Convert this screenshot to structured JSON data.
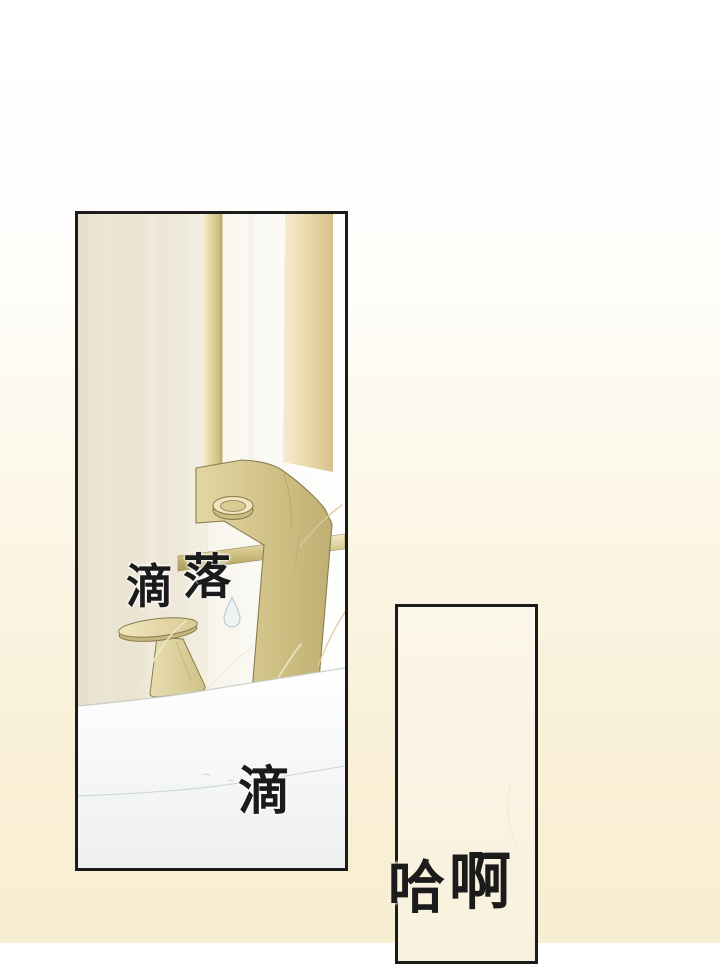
{
  "page": {
    "kind": "webtoon comic page",
    "scene": "bathroom brass faucet dripping into white sink; second partially-visible empty panel"
  },
  "sfx": {
    "drip_fall": "滴落",
    "drip_fall_char1": "滴",
    "drip_fall_char2": "落",
    "drip": "滴",
    "sigh": "哈啊",
    "sigh_char1": "哈",
    "sigh_char2": "啊"
  },
  "colors": {
    "ink": "#1b1b1b",
    "page_top": "#ffffff",
    "page_bottom": "#f8eed2",
    "panel2_top": "#fbf6ea",
    "panel2_fill": "#f8f1dd",
    "halo_white": "#ffffff",
    "halo_cream": "#f8f1dd",
    "brass_outline": "#8a7c4e",
    "brass_hi": "#f4edcd",
    "brass_light": "#e6d8a0",
    "brass_mid": "#d2c284",
    "brass_dark": "#bfae6e",
    "rail_hi": "#f4ebc6",
    "rail_dark": "#a99855",
    "faucet_light": "#e2d6a4",
    "faucet_mid": "#cfc084",
    "faucet_dark": "#bfaf72",
    "crease": "#b3a468",
    "aerator_face": "#f0e7c0",
    "aerator_inner": "#d9cc95",
    "aerator_under": "#cbbc82",
    "disc_light": "#f0e6bf",
    "disc_dark": "#d9cb92",
    "disc_side": "#c6b77e",
    "stem_light": "#e8deb0",
    "stem_dark": "#cfc189",
    "wall_edge": "#e9e2cf",
    "wall_left": "#f2eee1",
    "wall_white_l": "#f7f5ec",
    "wall_white": "#ffffff",
    "band_light": "#f7ecd2",
    "band_mid": "#e8d6a7",
    "band_dark": "#d5c18a",
    "sink_top": "#ffffff",
    "sink_bottom": "#edf0ee",
    "sink_line": "#c6ccc4",
    "water_line": "#bdcac5",
    "drop_fill": "#eef3f4",
    "drop_stroke": "#b5c2c6",
    "arc_light": "#f2ecd8",
    "arc_tan": "#dbcda2"
  }
}
